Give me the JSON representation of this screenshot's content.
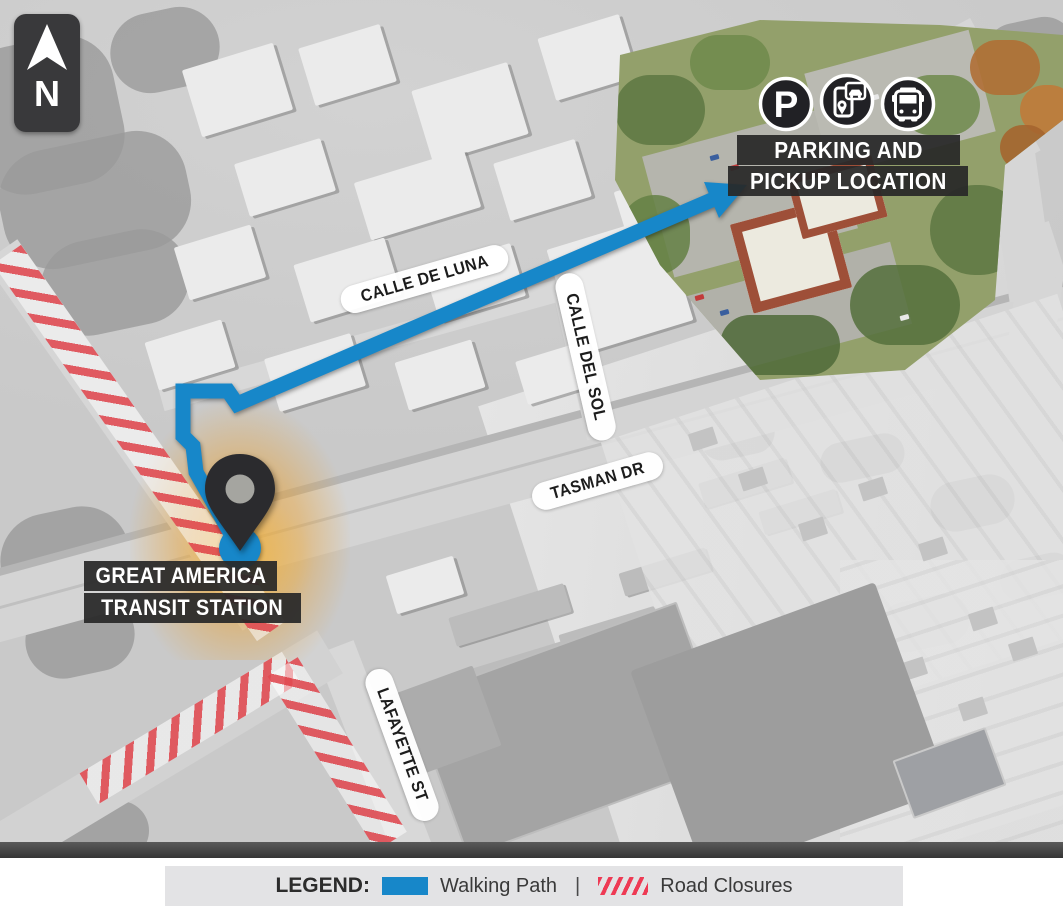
{
  "compass": {
    "label": "N"
  },
  "streets": {
    "calle_de_luna": "CALLE DE LUNA",
    "calle_del_sol": "CALLE DEL SOL",
    "tasman": "TASMAN DR",
    "lafayette": "LAFAYETTE ST"
  },
  "station": {
    "line1": "GREAT AMERICA",
    "line2": "TRANSIT STATION"
  },
  "destination": {
    "line1": "PARKING AND",
    "line2": "PICKUP LOCATION",
    "parking_glyph": "P",
    "icons": [
      "parking-icon",
      "rideshare-app-icon",
      "bus-icon"
    ]
  },
  "legend": {
    "title": "LEGEND:",
    "walking_path": "Walking Path",
    "separator": "|",
    "road_closures": "Road Closures"
  },
  "colors": {
    "walking_path": "#1787c9",
    "road_closure": "#e23a48",
    "label_bar": "#282828",
    "station_glow": "#e9a030"
  }
}
